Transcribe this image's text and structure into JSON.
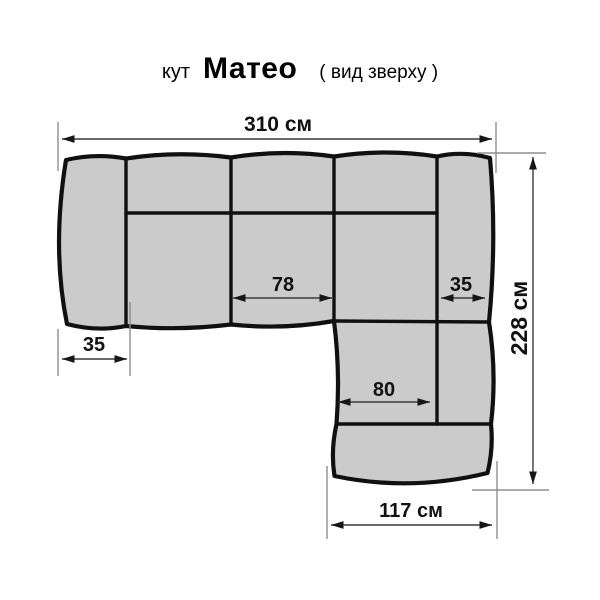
{
  "title": {
    "category": "кут",
    "product_name": "Матео",
    "view_note": "( вид зверху )"
  },
  "diagram": {
    "kind": "corner-sofa-top-view",
    "colors": {
      "highlight": "#e10000",
      "text": "#111111",
      "sofa_fill": "#cbcbcb",
      "outline": "#101010",
      "extension_line": "#8f8f8f",
      "dimension_line": "#3a3a3a"
    },
    "dimensions": {
      "total_width": {
        "label": "310 см",
        "value_cm": 310
      },
      "total_depth": {
        "label": "228 см",
        "value_cm": 228
      },
      "seat_width": {
        "label": "78",
        "value_cm": 78
      },
      "right_armrest": {
        "label": "35",
        "value_cm": 35
      },
      "left_armrest": {
        "label": "35",
        "value_cm": 35
      },
      "chaise_seat": {
        "label": "80",
        "value_cm": 80
      },
      "chaise_width": {
        "label": "117 см",
        "value_cm": 117
      }
    }
  }
}
